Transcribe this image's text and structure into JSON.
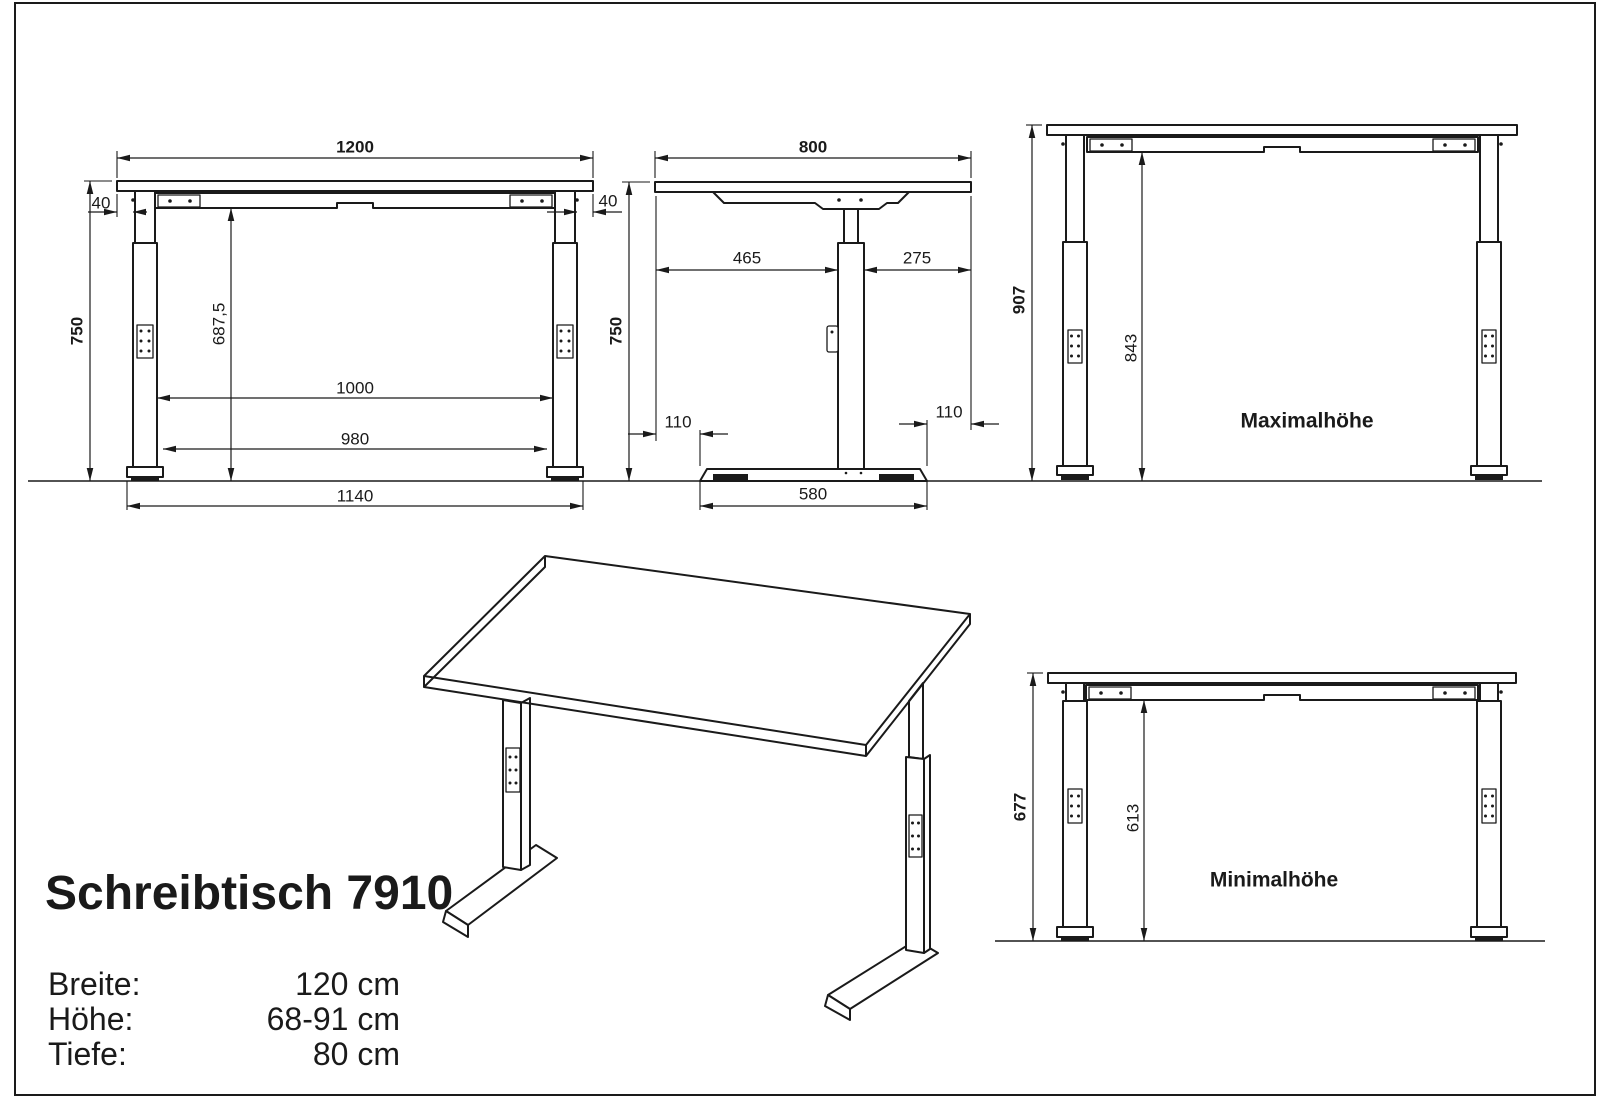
{
  "page": {
    "background": "#ffffff",
    "line_color": "#1a1a1a"
  },
  "title": "Schreibtisch 7910",
  "specs": [
    {
      "label": "Breite:",
      "value": "120 cm"
    },
    {
      "label": "Höhe:",
      "value": "68-91 cm"
    },
    {
      "label": "Tiefe:",
      "value": "80 cm"
    }
  ],
  "front_view": {
    "dims": {
      "top_width": "1200",
      "overhang_left": "40",
      "overhang_right": "40",
      "height": "750",
      "underframe_clearance": "687,5",
      "leg_inner_width": "1000",
      "feet_inner_width": "980",
      "feet_outer_width": "1140"
    }
  },
  "side_view": {
    "dims": {
      "top_depth": "800",
      "height": "750",
      "top_front_overhang": "465",
      "top_rear_overhang": "275",
      "foot_offset_front": "110",
      "foot_offset_rear": "110",
      "base_depth": "580"
    }
  },
  "max_view": {
    "label": "Maximalhöhe",
    "dims": {
      "height": "907",
      "underframe_clearance": "843"
    }
  },
  "min_view": {
    "label": "Minimalhöhe",
    "dims": {
      "height": "677",
      "underframe_clearance": "613"
    }
  }
}
